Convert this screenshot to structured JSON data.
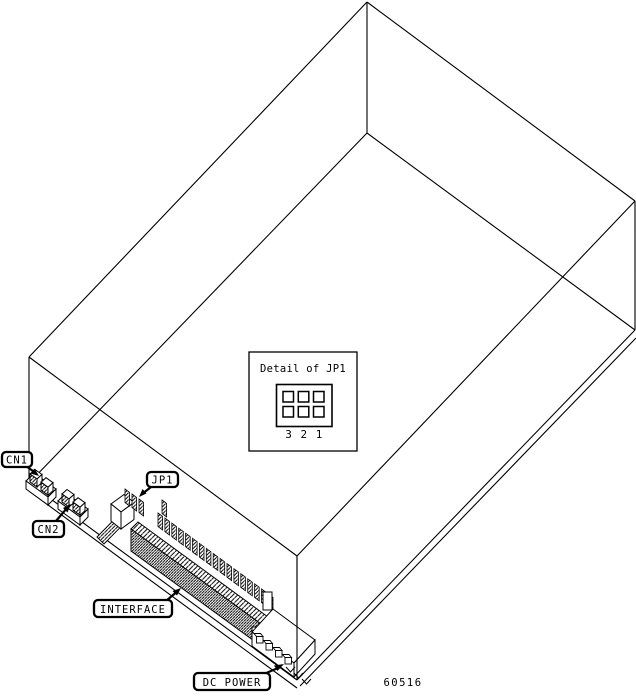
{
  "callouts": [
    {
      "label": "CN1"
    },
    {
      "label": "CN2"
    },
    {
      "label": "JP1"
    },
    {
      "label": "INTERFACE"
    },
    {
      "label": "DC POWER"
    }
  ],
  "detail_box": {
    "title": "Detail of JP1",
    "pin_numbers": [
      "3",
      "2",
      "1"
    ],
    "jumper_grid": {
      "rows": 2,
      "cols": 3
    }
  },
  "figure_number": "60516"
}
